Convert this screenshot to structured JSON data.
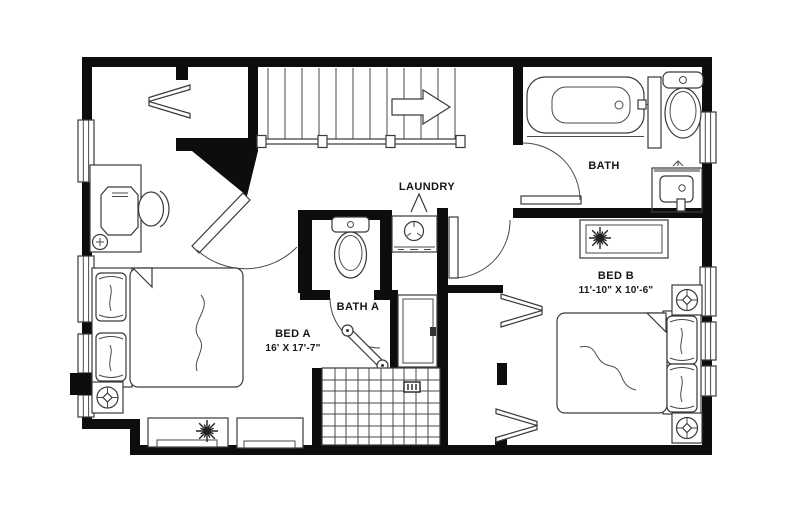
{
  "plan": {
    "background": "#ffffff",
    "wall_color": "#0d0d0d",
    "line_color": "#3a3a3a",
    "labels": {
      "laundry": "LAUNDRY",
      "bath": "BATH",
      "bath_a": "BATH A",
      "bed_a": "BED A",
      "bed_a_dims": "16' X 17'-7\"",
      "bed_b": "BED B",
      "bed_b_dims": "11'-10\" X 10'-6\""
    }
  }
}
